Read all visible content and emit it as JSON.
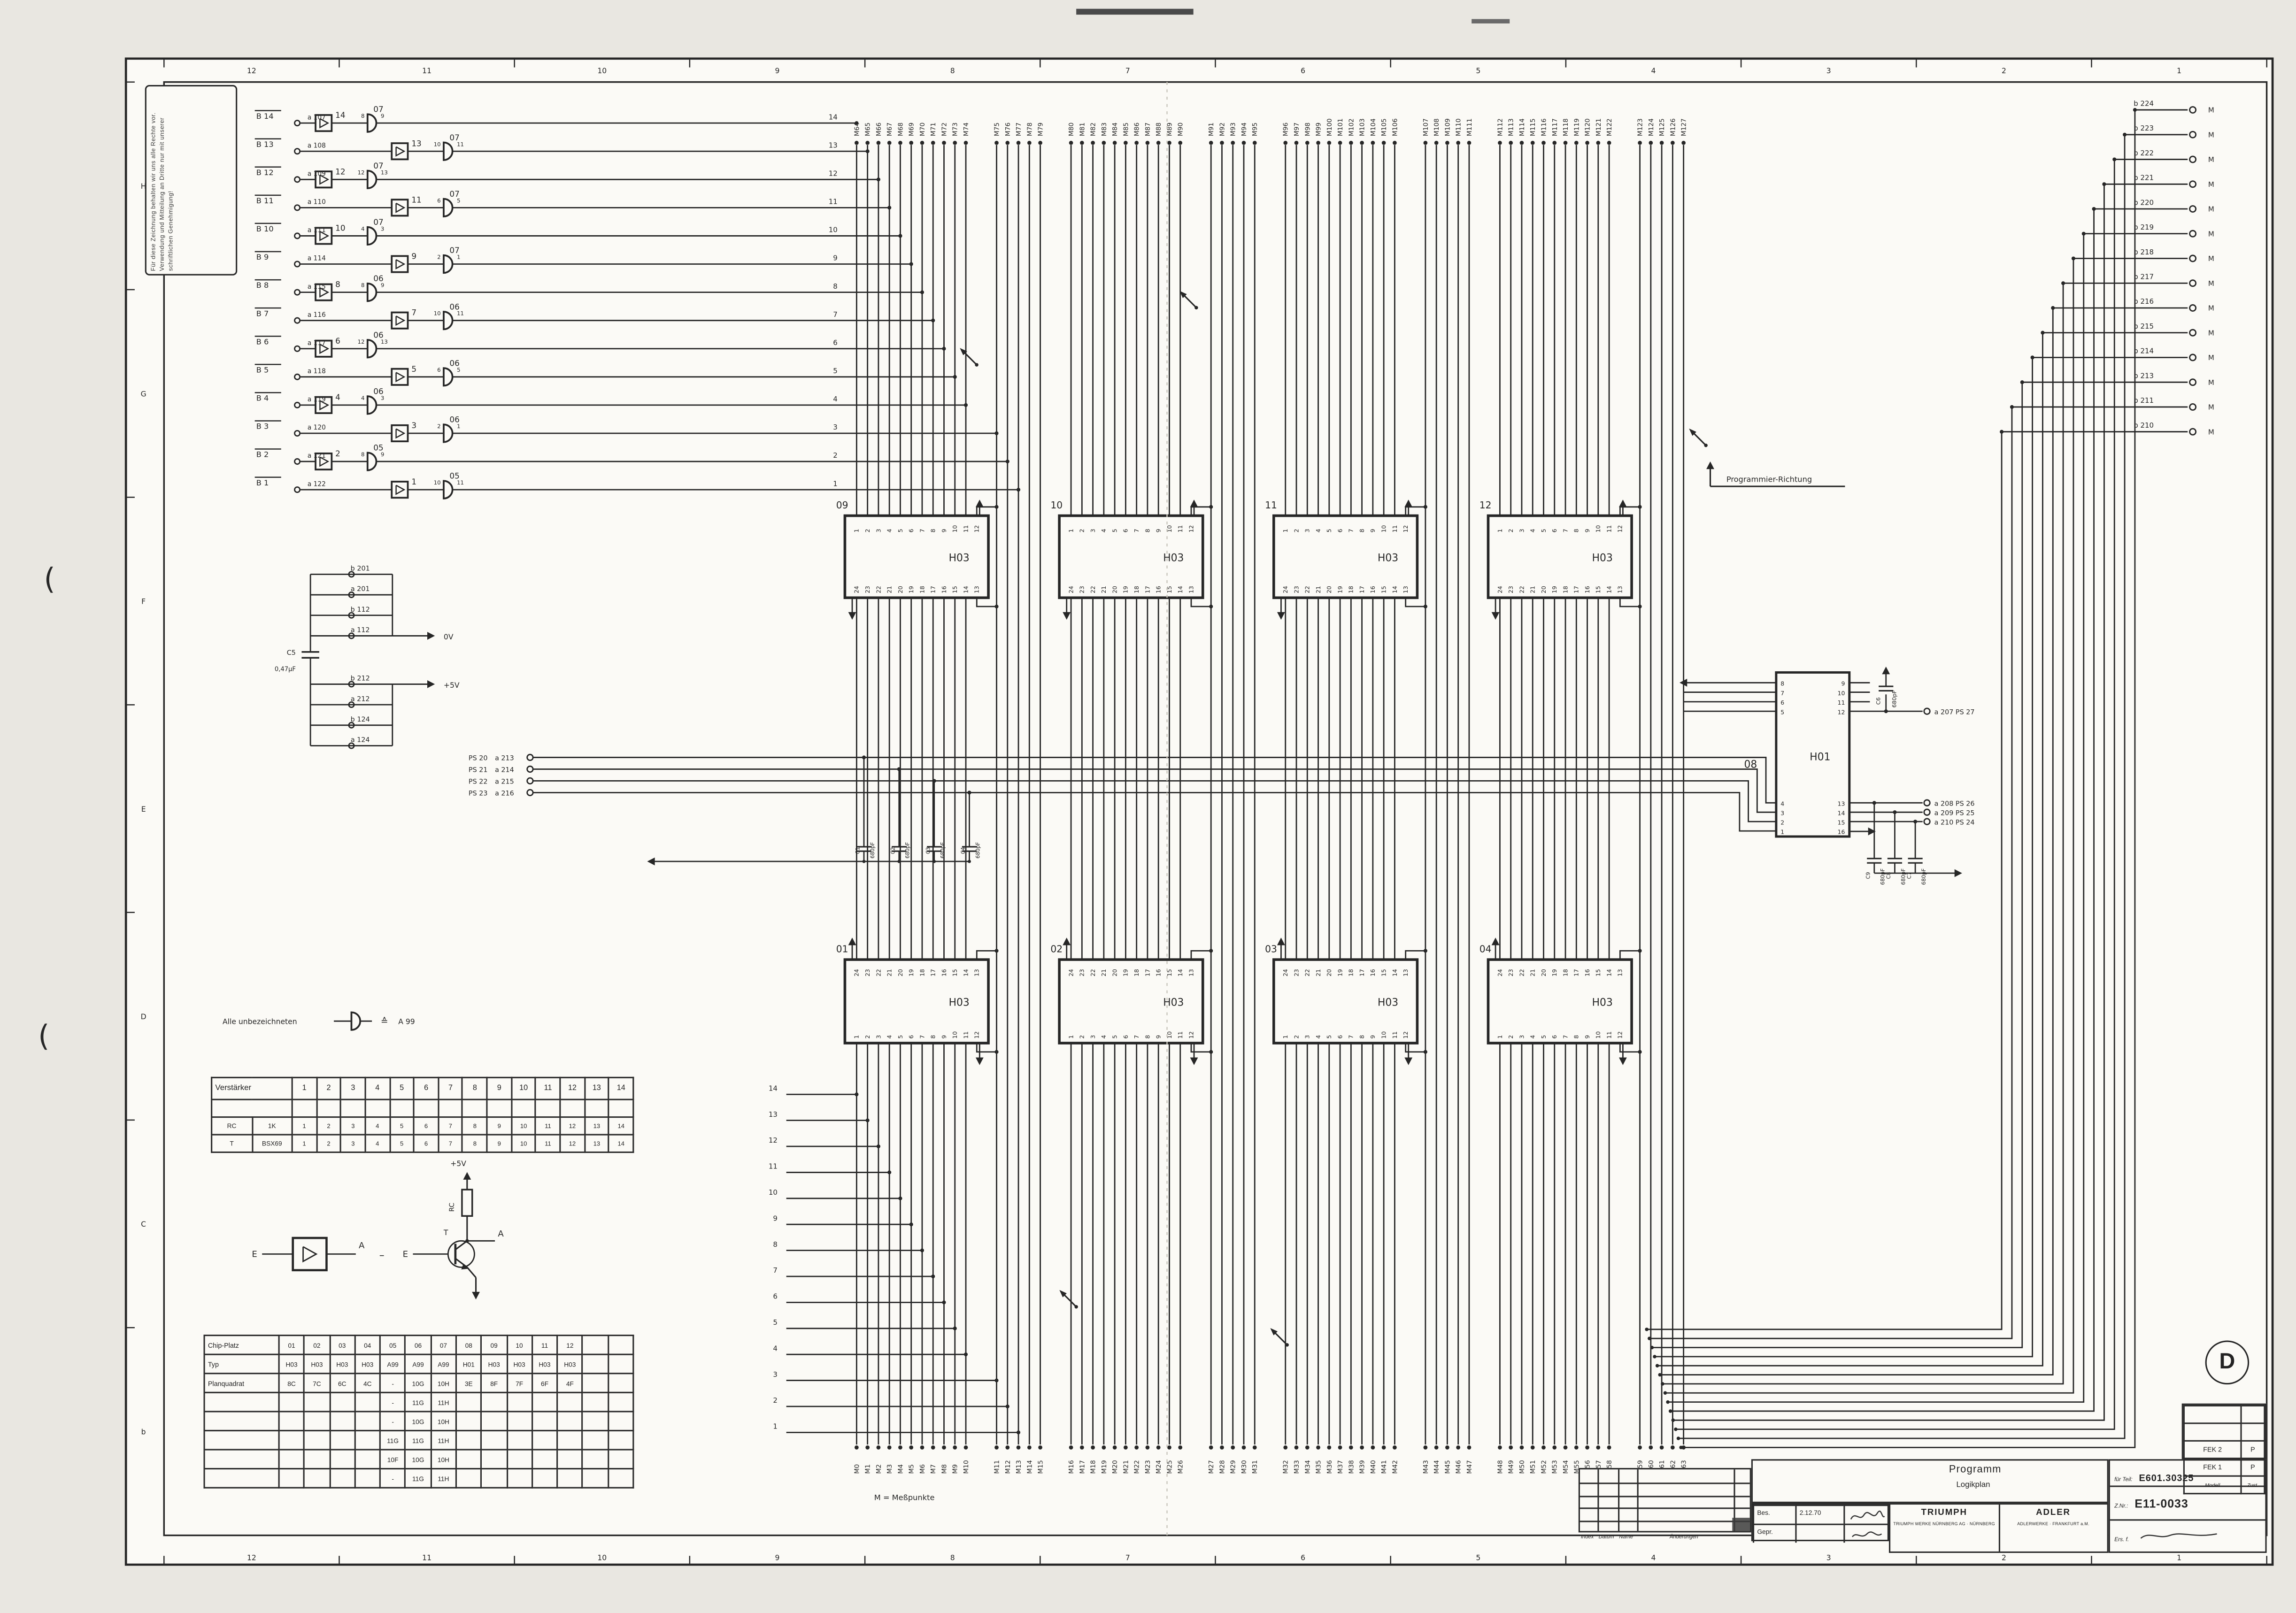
{
  "colors": {
    "ink": "#262626",
    "paper": "#e9e7e1",
    "sheet": "#fbfaf6"
  },
  "grid": {
    "cols": [
      "12",
      "11",
      "10",
      "9",
      "8",
      "7",
      "6",
      "5",
      "4",
      "3",
      "2",
      "1"
    ],
    "rows": [
      "H",
      "G",
      "F",
      "E",
      "D",
      "C",
      "b"
    ]
  },
  "stamp": {
    "text": "Für diese Zeichnung behalten wir uns alle Rechte vor. Verwendung und Mitteilung an Dritte nur mit unserer schriftlichen Genehmigung!"
  },
  "inputs": {
    "rows": [
      {
        "port": "B 14",
        "signal": "a 107",
        "amp": "14",
        "gate": "07",
        "pin_in": "8",
        "pin_out": "9"
      },
      {
        "port": "B 13",
        "signal": "a 108",
        "amp": "13",
        "gate": "07",
        "pin_in": "10",
        "pin_out": "11"
      },
      {
        "port": "B 12",
        "signal": "a 109",
        "amp": "12",
        "gate": "07",
        "pin_in": "12",
        "pin_out": "13"
      },
      {
        "port": "B 11",
        "signal": "a 110",
        "amp": "11",
        "gate": "07",
        "pin_in": "6",
        "pin_out": "5"
      },
      {
        "port": "B 10",
        "signal": "a 111",
        "amp": "10",
        "gate": "07",
        "pin_in": "4",
        "pin_out": "3"
      },
      {
        "port": "B 9",
        "signal": "a 114",
        "amp": "9",
        "gate": "07",
        "pin_in": "2",
        "pin_out": "1"
      },
      {
        "port": "B 8",
        "signal": "a 115",
        "amp": "8",
        "gate": "06",
        "pin_in": "8",
        "pin_out": "9"
      },
      {
        "port": "B 7",
        "signal": "a 116",
        "amp": "7",
        "gate": "06",
        "pin_in": "10",
        "pin_out": "11"
      },
      {
        "port": "B 6",
        "signal": "a 117",
        "amp": "6",
        "gate": "06",
        "pin_in": "12",
        "pin_out": "13"
      },
      {
        "port": "B 5",
        "signal": "a 118",
        "amp": "5",
        "gate": "06",
        "pin_in": "6",
        "pin_out": "5"
      },
      {
        "port": "B 4",
        "signal": "a 119",
        "amp": "4",
        "gate": "06",
        "pin_in": "4",
        "pin_out": "3"
      },
      {
        "port": "B 3",
        "signal": "a 120",
        "amp": "3",
        "gate": "06",
        "pin_in": "2",
        "pin_out": "1"
      },
      {
        "port": "B 2",
        "signal": "a 121",
        "amp": "2",
        "gate": "05",
        "pin_in": "8",
        "pin_out": "9"
      },
      {
        "port": "B 1",
        "signal": "a 122",
        "amp": "1",
        "gate": "05",
        "pin_in": "10",
        "pin_out": "11"
      }
    ],
    "line_numbers": [
      "14",
      "13",
      "12",
      "11",
      "10",
      "9",
      "8",
      "7",
      "6",
      "5",
      "4",
      "3",
      "2",
      "1"
    ]
  },
  "top_bus": [
    "M64",
    "M65",
    "M66",
    "M67",
    "M68",
    "M69",
    "M70",
    "M71",
    "M72",
    "M73",
    "M74",
    "M75",
    "M76",
    "M77",
    "M78",
    "M79",
    "M80",
    "M81",
    "M82",
    "M83",
    "M84",
    "M85",
    "M86",
    "M87",
    "M88",
    "M89",
    "M90",
    "M91",
    "M92",
    "M93",
    "M94",
    "M95",
    "M96",
    "M97",
    "M98",
    "M99",
    "M100",
    "M101",
    "M102",
    "M103",
    "M104",
    "M105",
    "M106",
    "M107",
    "M108",
    "M109",
    "M110",
    "M111",
    "M112",
    "M113",
    "M114",
    "M115",
    "M116",
    "M117",
    "M118",
    "M119",
    "M120",
    "M121",
    "M122",
    "M123",
    "M124",
    "M125",
    "M126",
    "M127"
  ],
  "bottom_bus": [
    "M0",
    "M1",
    "M2",
    "M3",
    "M4",
    "M5",
    "M6",
    "M7",
    "M8",
    "M9",
    "M10",
    "M11",
    "M12",
    "M13",
    "M14",
    "M15",
    "M16",
    "M17",
    "M18",
    "M19",
    "M20",
    "M21",
    "M22",
    "M23",
    "M24",
    "M25",
    "M26",
    "M27",
    "M28",
    "M29",
    "M30",
    "M31",
    "M32",
    "M33",
    "M34",
    "M35",
    "M36",
    "M37",
    "M38",
    "M39",
    "M40",
    "M41",
    "M42",
    "M43",
    "M44",
    "M45",
    "M46",
    "M47",
    "M48",
    "M49",
    "M50",
    "M51",
    "M52",
    "M53",
    "M54",
    "M55",
    "M56",
    "M57",
    "M58",
    "M59",
    "M60",
    "M61",
    "M62",
    "M63"
  ],
  "right_ports": {
    "labels": [
      "b 224",
      "b 223",
      "b 222",
      "b 221",
      "b 220",
      "b 219",
      "b 218",
      "b 217",
      "b 216",
      "b 215",
      "b 214",
      "b 213",
      "b 211",
      "b 210"
    ],
    "mark": "M"
  },
  "mid_chips": {
    "type": "H03",
    "positions": [
      "09",
      "10",
      "11",
      "12"
    ],
    "top_pins": [
      "1",
      "2",
      "3",
      "4",
      "5",
      "6",
      "7",
      "8",
      "9",
      "10",
      "11",
      "12"
    ],
    "bottom_pins": [
      "24",
      "23",
      "22",
      "21",
      "20",
      "19",
      "18",
      "17",
      "16",
      "15",
      "14",
      "13"
    ]
  },
  "bottom_chips": {
    "type": "H03",
    "positions": [
      "01",
      "02",
      "03",
      "04"
    ],
    "top_pins": [
      "24",
      "23",
      "22",
      "21",
      "20",
      "19",
      "18",
      "17",
      "16",
      "15",
      "14",
      "13"
    ],
    "bottom_pins": [
      "1",
      "2",
      "3",
      "4",
      "5",
      "6",
      "7",
      "8",
      "9",
      "10",
      "11",
      "12"
    ]
  },
  "h01": {
    "position": "08",
    "type": "H01",
    "left_top_pins": [
      "8",
      "7",
      "6",
      "5"
    ],
    "left_bottom_pins": [
      "4",
      "3",
      "2",
      "1"
    ],
    "right_top_pins": [
      "9",
      "10",
      "11",
      "12"
    ],
    "right_bottom_pins": [
      "13",
      "14",
      "15",
      "16"
    ],
    "cap_top": {
      "name": "C6",
      "value": "680pF"
    },
    "out_top": "a 207 PS 27",
    "outs": [
      {
        "pin": "13",
        "label": "a 208 PS 26"
      },
      {
        "pin": "14",
        "label": "a 209 PS 25"
      },
      {
        "pin": "15",
        "label": "a 210 PS 24"
      }
    ],
    "caps": [
      {
        "name": "C9",
        "value": "680pF"
      },
      {
        "name": "C8",
        "value": "680pF"
      },
      {
        "name": "C7",
        "value": "680pF"
      }
    ]
  },
  "power": {
    "top_group": [
      "b 201",
      "a 201",
      "b 112",
      "a 112"
    ],
    "top_rail": "0V",
    "cap": {
      "name": "C5",
      "value": "0,47µF"
    },
    "bottom_group": [
      "b 212",
      "a 212",
      "b 124",
      "a 124"
    ],
    "bottom_rail": "+5V"
  },
  "ps": {
    "rows": [
      {
        "label": "PS 20",
        "signal": "a 213"
      },
      {
        "label": "PS 21",
        "signal": "a 214"
      },
      {
        "label": "PS 22",
        "signal": "a 215"
      },
      {
        "label": "PS 23",
        "signal": "a 216"
      }
    ],
    "caps": [
      {
        "name": "C1",
        "value": "680pF"
      },
      {
        "name": "C2",
        "value": "680pF"
      },
      {
        "name": "C3",
        "value": "680pF"
      },
      {
        "name": "C4",
        "value": "680pF"
      }
    ]
  },
  "amp_note": {
    "text": "Alle unbezeichneten",
    "equiv": "≙",
    "value": "A 99"
  },
  "equivalence": {
    "in": "E",
    "out": "A",
    "dash": "–",
    "transistor": "T",
    "resistor": "RC",
    "rail": "+5V"
  },
  "verstaerker_table": {
    "title": "Verstärker",
    "columns": [
      "1",
      "2",
      "3",
      "4",
      "5",
      "6",
      "7",
      "8",
      "9",
      "10",
      "11",
      "12",
      "13",
      "14"
    ],
    "rows": [
      {
        "name": "RC",
        "part": "1K",
        "values": [
          "1",
          "2",
          "3",
          "4",
          "5",
          "6",
          "7",
          "8",
          "9",
          "10",
          "11",
          "12",
          "13",
          "14"
        ]
      },
      {
        "name": "T",
        "part": "BSX69",
        "values": [
          "1",
          "2",
          "3",
          "4",
          "5",
          "6",
          "7",
          "8",
          "9",
          "10",
          "11",
          "12",
          "13",
          "14"
        ]
      }
    ]
  },
  "chip_table": {
    "row_headers": [
      "Chip-Platz",
      "Typ",
      "Planquadrat"
    ],
    "platz": [
      "01",
      "02",
      "03",
      "04",
      "05",
      "06",
      "07",
      "08",
      "09",
      "10",
      "11",
      "12"
    ],
    "typ": [
      "H03",
      "H03",
      "H03",
      "H03",
      "A99",
      "A99",
      "A99",
      "H01",
      "H03",
      "H03",
      "H03",
      "H03"
    ],
    "plan": [
      "8C",
      "7C",
      "6C",
      "4C",
      "-",
      "10G",
      "10H",
      "3E",
      "8F",
      "7F",
      "6F",
      "4F"
    ],
    "extra_rows": [
      [
        "-",
        "11G",
        "11H"
      ],
      [
        "-",
        "10G",
        "10H"
      ],
      [
        "11G",
        "11G",
        "11H"
      ],
      [
        "10F",
        "10G",
        "10H"
      ],
      [
        "-",
        "11G",
        "11H"
      ]
    ]
  },
  "prog_note": "Programmier-Richtung",
  "mess_note": "M = Meßpunkte",
  "title_block": {
    "title": "Programm",
    "subtitle": "Logikplan",
    "rev_cols": [
      "Index",
      "Datum",
      "Name",
      "Änderungen"
    ],
    "bes": "Bes.",
    "gepr": "Gepr.",
    "date": "2.12.70",
    "firm1": "TRIUMPH",
    "firm1_sub": "TRIUMPH WERKE NÜRNBERG AG · NÜRNBERG",
    "firm2": "ADLER",
    "firm2_sub": "ADLERWERKE · FRANKFURT a.M.",
    "teil_label": "für Teil:",
    "teil": "E601.30325",
    "znr_label": "Z.Nr.:",
    "znr": "E11-0033",
    "ers": "Ers. f.",
    "fek": [
      {
        "a": "FEK 2",
        "b": "P"
      },
      {
        "a": "FEK 1",
        "b": "P"
      }
    ],
    "fek_foot": {
      "a": "Modell",
      "b": "Zust."
    },
    "d": "D"
  }
}
